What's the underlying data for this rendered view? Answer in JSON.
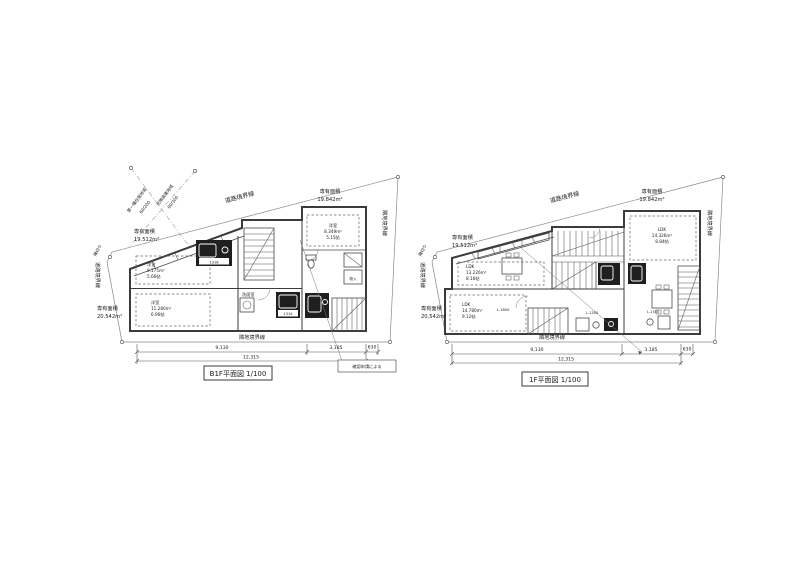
{
  "sheet": {
    "bg": "#ffffff",
    "ink": "#3b3b3b",
    "boundary_line": "#8a8a8a",
    "dark_fill": "#1f1f1f"
  },
  "plans": [
    {
      "title": "B1F平面図 1/100",
      "boundaries": {
        "road_top": "道路境界線",
        "road_left": "道路境界線",
        "adjacent_right": "隣地境界線",
        "adjacent_bottom": "隣地境界線",
        "corner_cut": "隅切り"
      },
      "zoning": {
        "district_a": "第一種住居地域",
        "ratio_a": "60/200",
        "district_b": "近隣商業地域",
        "ratio_b": "80/300"
      },
      "areas": {
        "top_right": {
          "label": "専有面積",
          "value": "19.842m²"
        },
        "left": {
          "label": "専有面積",
          "value": "19.512m²"
        },
        "bottom": {
          "label": "専有面積",
          "value": "20.542m²"
        }
      },
      "rooms": {
        "left_upper": {
          "name": "洋室",
          "area": "9.175m²",
          "size": "5.66帖"
        },
        "left_lower": {
          "name": "洋室",
          "area": "11.280m²",
          "size": "6.96帖"
        },
        "right": {
          "name": "洋室",
          "area": "8.349m²",
          "size": "5.15帖"
        }
      },
      "fixtures": {
        "washroom": "洗面室",
        "bath_a": "1318",
        "bath_b": "1314",
        "storage": "物入"
      },
      "dimensions": {
        "seg1": "9,130",
        "seg2": "3,185",
        "seg3": "630",
        "total": "12,315"
      },
      "note": "確認申請による"
    },
    {
      "title": "1F平面図 1/100",
      "boundaries": {
        "road_top": "道路境界線",
        "road_left": "道路境界線",
        "adjacent_right": "隣地境界線",
        "adjacent_bottom": "隣地境界線",
        "corner_cut": "隅切り"
      },
      "areas": {
        "top_right": {
          "label": "専有面積",
          "value": "19.842m²"
        },
        "left": {
          "label": "専有面積",
          "value": "19.512m²"
        },
        "bottom": {
          "label": "専有面積",
          "value": "20.542m²"
        }
      },
      "rooms": {
        "left": {
          "name": "LDK",
          "area": "13.226m²",
          "size": "8.16帖"
        },
        "bottom": {
          "name": "LDK",
          "area": "14.780m²",
          "size": "9.12帖"
        },
        "right": {
          "name": "LDK",
          "area": "14.326m²",
          "size": "8.84帖"
        }
      },
      "fixtures": {
        "kitchen_main": "L-1800",
        "kitchen_sub_a": "L-1350",
        "kitchen_sub_b": "L-1350"
      },
      "dimensions": {
        "seg1": "9,130",
        "seg2": "3,185",
        "seg3": "630",
        "total": "12,315"
      }
    }
  ]
}
